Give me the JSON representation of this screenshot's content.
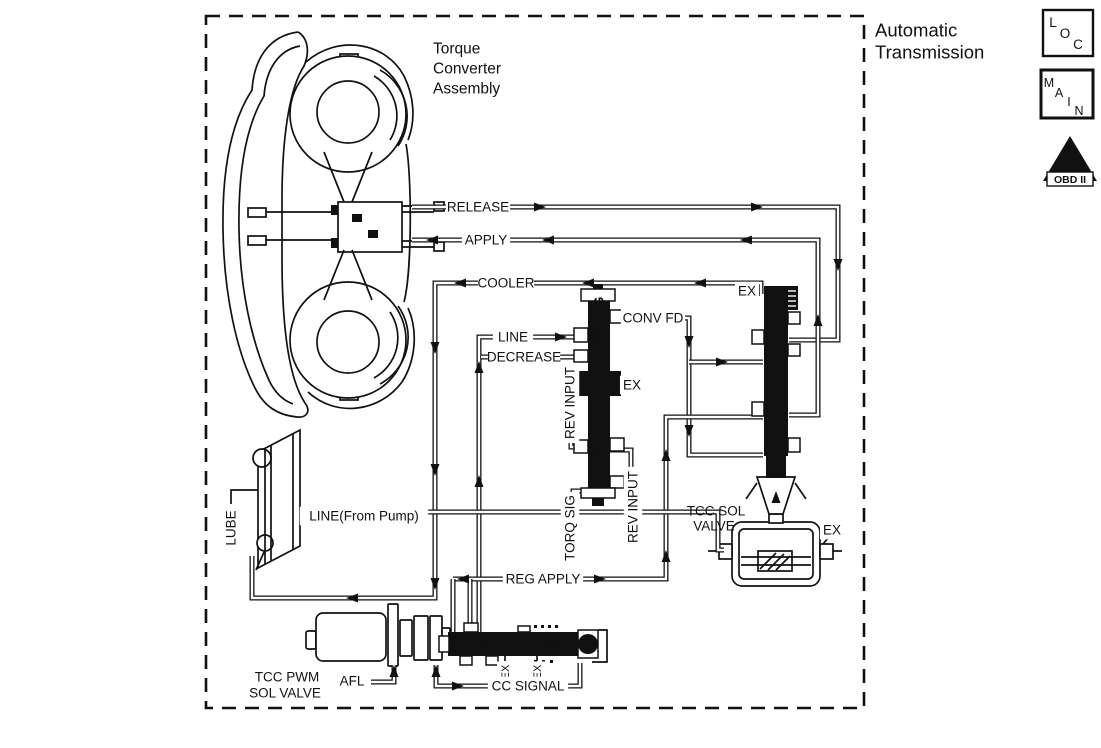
{
  "title": [
    "Automatic",
    "Transmission"
  ],
  "labels": {
    "torque_converter": [
      "Torque",
      "Converter",
      "Assembly"
    ],
    "release": "RELEASE",
    "apply": "APPLY",
    "cooler": "COOLER",
    "conv_fd": "CONV FD",
    "line": "LINE",
    "decrease": "DECREASE",
    "ex": "EX",
    "rev_input": "REV INPUT",
    "torq_sig": "TORQ SIG",
    "lube": "LUBE",
    "line_from_pump": "LINE(From Pump)",
    "reg_apply": "REG APPLY",
    "afl": "AFL",
    "cc_signal": "CC SIGNAL",
    "tcc_sol_valve": [
      "TCC SOL",
      "VALVE"
    ],
    "tcc_pwm_sol_valve": [
      "TCC PWM",
      "SOL VALVE"
    ],
    "press_reg": "PRESS REG",
    "boost_valve": "BOOST VALVE",
    "conv_clu_valve": "CONV CLU VALVE",
    "iso_valve": "REG APPLY (ISO"
  },
  "legend": {
    "loc": "LOC",
    "main": "MAIN",
    "obd_numeral": "II",
    "obd_banner": "OBD II"
  },
  "colors": {
    "ink": "#111111",
    "bg": "#ffffff"
  }
}
